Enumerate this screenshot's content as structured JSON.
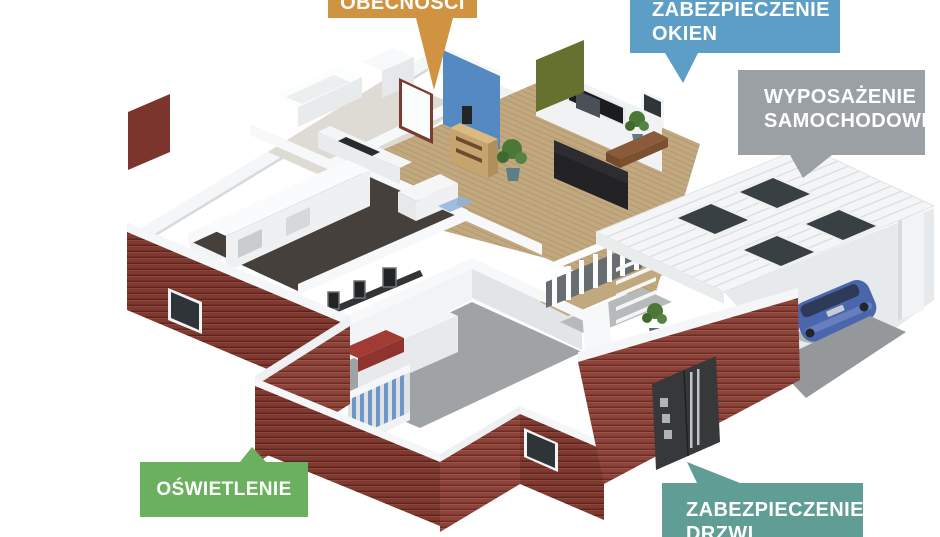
{
  "scene": {
    "description": "Isometric 3D cutaway floor plan of a smart home with attached carport, brick exterior walls, furnished rooms and a blue car"
  },
  "callouts": {
    "presence_simulation": {
      "label": "OBECNOŚCI",
      "color": "#cf9342"
    },
    "window_protection": {
      "line1": "ZABEZPIECZENIE",
      "line2": "OKIEN",
      "color": "#5d9ec6"
    },
    "car_equipment": {
      "line1": "WYPOSAŻENIE",
      "line2": "SAMOCHODOWE",
      "color": "#9aa0a4"
    },
    "lighting": {
      "label": "OŚWIETLENIE",
      "color": "#6bb05e"
    },
    "door_protection": {
      "line1": "ZABEZPIECZENIE",
      "line2": "DRZWI",
      "color": "#5f9d95"
    }
  },
  "palette": {
    "brick_dark": "#81392f",
    "brick_light": "#8f4338",
    "wood_floor": "#c2a87e",
    "floor_gray": "#a0a3a5",
    "floor_dark": "#45403b",
    "accent_wall_blue": "#5589c2",
    "accent_wall_olive": "#66702f",
    "car_blue": "#4a66ad",
    "bed_blanket_red": "#a33b35",
    "front_door": "#37383a"
  }
}
